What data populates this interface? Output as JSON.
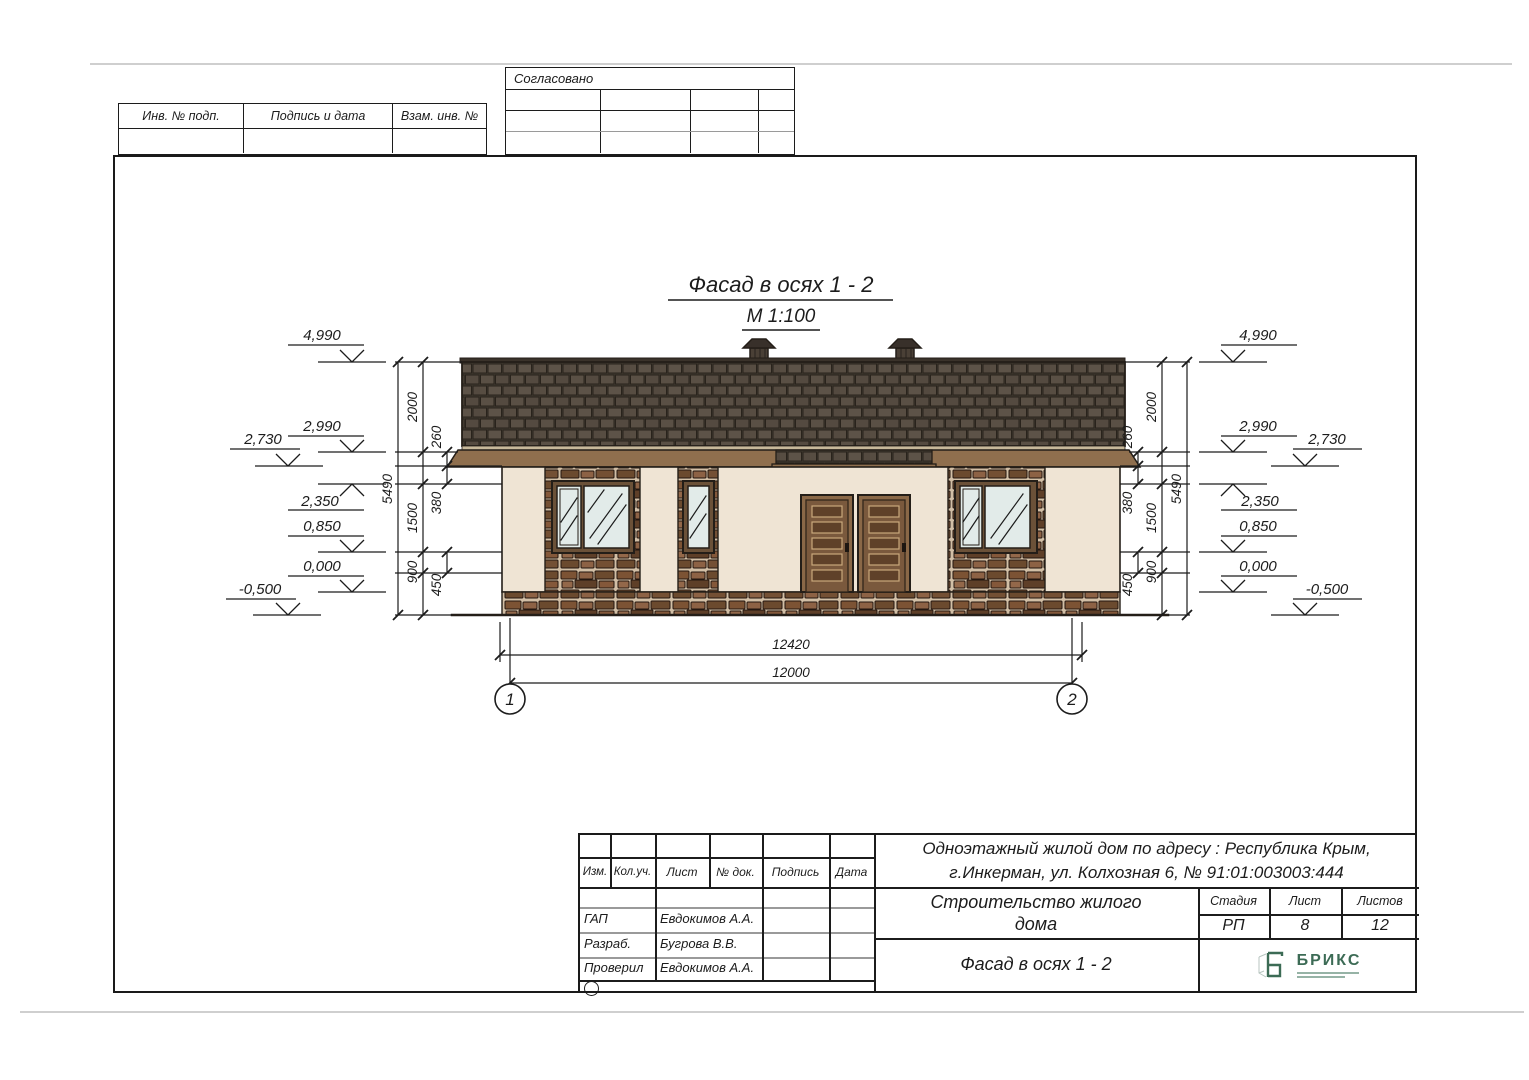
{
  "page": {
    "stamp_top": {
      "inv": "Инв. № подп.",
      "podpis": "Подпись и дата",
      "vzam": "Взам. инв. №"
    },
    "approval": {
      "title": "Согласовано"
    },
    "drawing": {
      "title": "Фасад в осях   1 - 2",
      "scale": "М 1:100",
      "axis1": "1",
      "axis2": "2",
      "elev": {
        "e4990": "4,990",
        "e2990": "2,990",
        "e2730": "2,730",
        "e2350": "2,350",
        "e0850": "0,850",
        "e0000": "0,000",
        "em0500": "-0,500"
      },
      "dims": {
        "total": "5490",
        "d2000": "2000",
        "d1500": "1500",
        "d900": "900",
        "d260": "260",
        "d380": "380",
        "d450": "450",
        "w_outer": "12420",
        "w_inner": "12000"
      }
    },
    "titleblock": {
      "col_izm": "Изм.",
      "col_koluch": "Кол.уч.",
      "col_list": "Лист",
      "col_ndok": "№ док.",
      "col_podpis": "Подпись",
      "col_data": "Дата",
      "gap_role": "ГАП",
      "gap_name": "Евдокимов А.А.",
      "razrab_role": "Разраб.",
      "razrab_name": "Бугрова В.В.",
      "proveril_role": "Проверил",
      "proveril_name": "Евдокимов А.А.",
      "addr1": "Одноэтажный жилой дом по адресу : Республика Крым,",
      "addr2": "г.Инкерман, ул. Колхозная 6, № 91:01:003003:444",
      "object1": "Строительство жилого",
      "object2": "дома",
      "stage_label": "Стадия",
      "list_label": "Лист",
      "listov_label": "Листов",
      "stage": "РП",
      "list": "8",
      "listov": "12",
      "sheet_title": "Фасад в осях   1 - 2",
      "logo": "БРИКС"
    }
  }
}
